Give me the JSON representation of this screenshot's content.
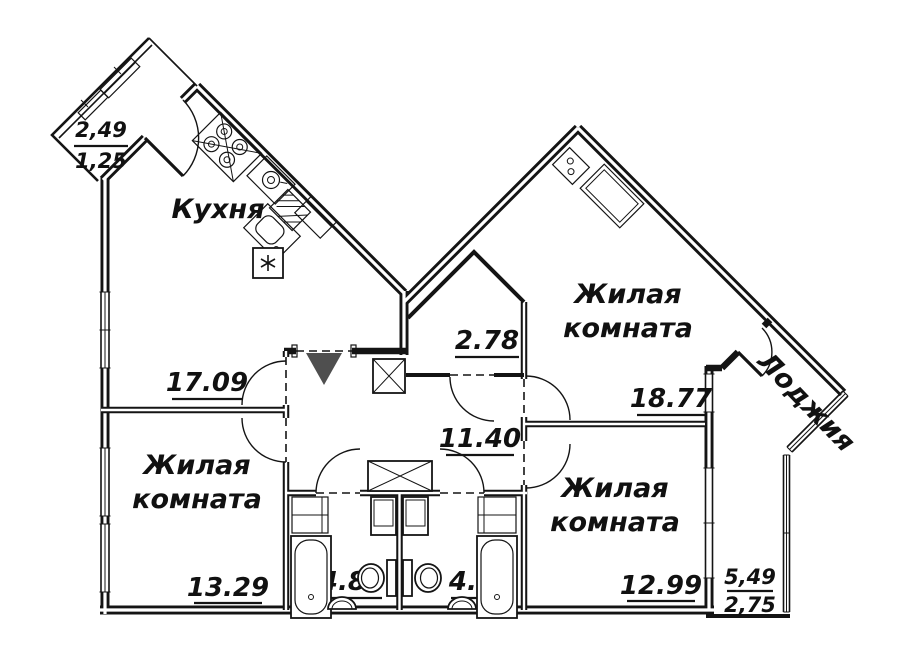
{
  "colors": {
    "background": "#ffffff",
    "lines": "#141414",
    "entry_arrow": "#4f4f4f"
  },
  "rooms": {
    "kitchen": {
      "name": "Кухня",
      "area": "17.09"
    },
    "living_left": {
      "name_l1": "Жилая",
      "name_l2": "комната",
      "area": "13.29"
    },
    "living_top": {
      "name_l1": "Жилая",
      "name_l2": "комната",
      "area": "18.77"
    },
    "living_right": {
      "name_l1": "Жилая",
      "name_l2": "комната",
      "area": "12.99"
    },
    "hallway": {
      "area": "11.40"
    },
    "storage": {
      "area": "2.78"
    },
    "bathroom_left": {
      "area": "4.84"
    },
    "bathroom_right": {
      "area": "4.77"
    },
    "balcony": {
      "area_full": "2,49",
      "area_reduced": "1,25"
    },
    "loggia": {
      "name": "Лоджия",
      "area_full": "5,49",
      "area_reduced": "2,75"
    }
  }
}
